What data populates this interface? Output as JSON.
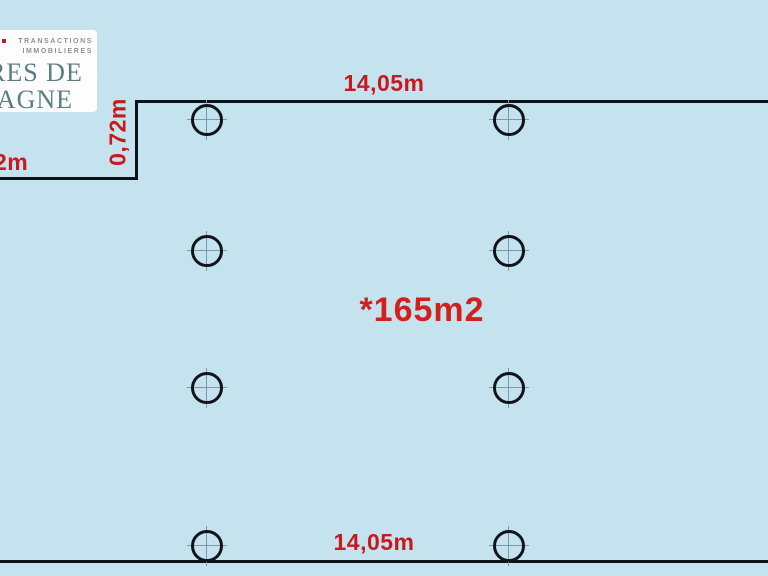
{
  "canvas": {
    "background": "#c4e3ee"
  },
  "logo": {
    "tagline_line1": "TRANSACTIONS",
    "tagline_line2": "IMMOBILIERES",
    "name_line1": "RES DE",
    "name_line2": "TAGNE",
    "colors": {
      "name": "#5b7e86",
      "tagline": "#8e9194",
      "accent": "#c02026",
      "box": "#fdfdfd"
    }
  },
  "plan": {
    "area_label": "*165m2",
    "dim_top": "14,05m",
    "dim_bottom": "14,05m",
    "dim_step": "0,72m",
    "dim_left": "2m",
    "colors": {
      "dimension": "#c8191e",
      "area": "#d2211c",
      "wall": "#0d1118"
    },
    "survey_points": [
      {
        "x": 207,
        "y": 120
      },
      {
        "x": 509,
        "y": 120
      },
      {
        "x": 207,
        "y": 251
      },
      {
        "x": 509,
        "y": 251
      },
      {
        "x": 207,
        "y": 388
      },
      {
        "x": 509,
        "y": 388
      },
      {
        "x": 207,
        "y": 546
      },
      {
        "x": 509,
        "y": 546
      }
    ]
  }
}
